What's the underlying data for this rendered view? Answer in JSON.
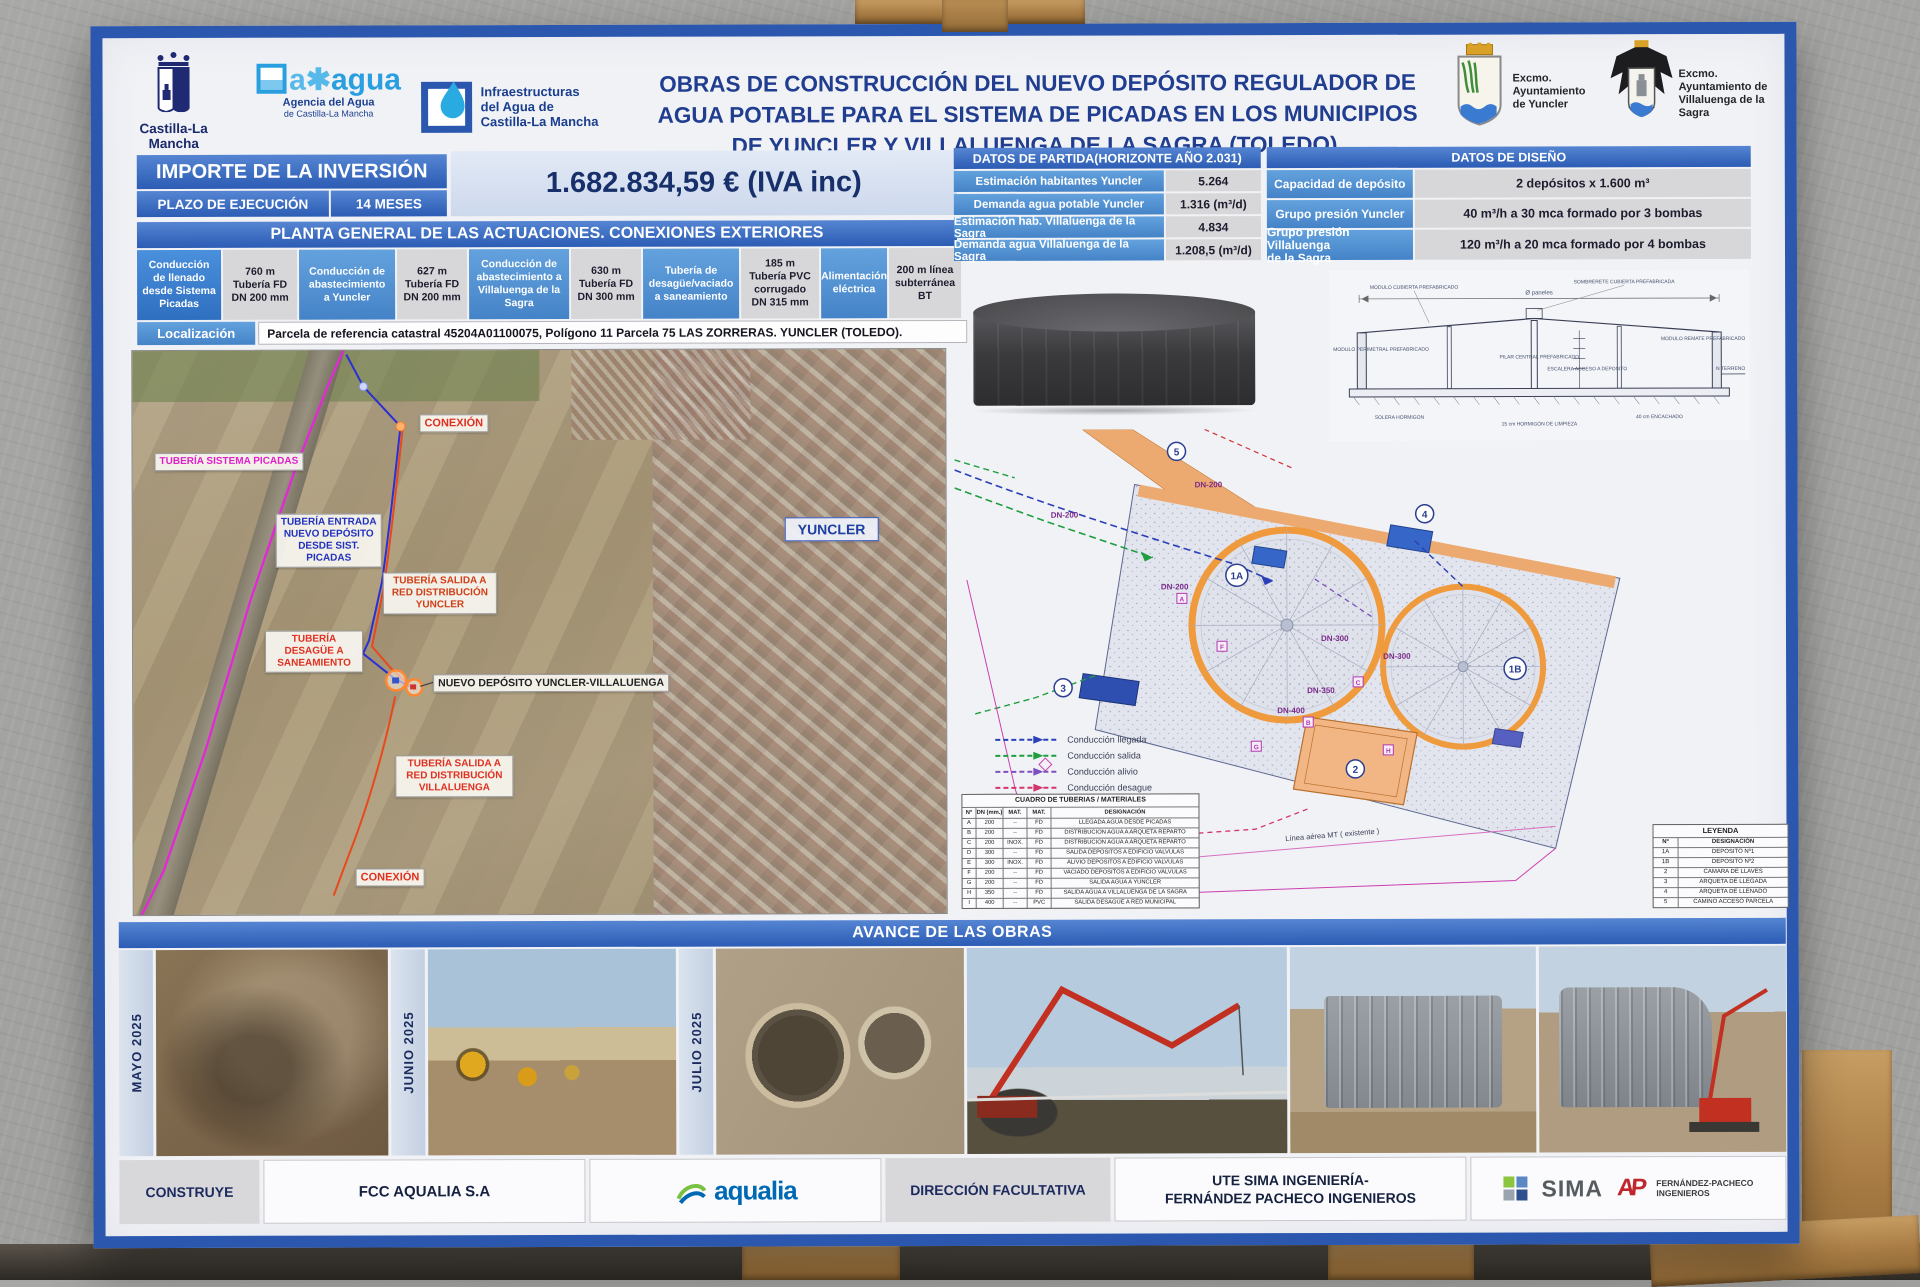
{
  "header": {
    "title": "OBRAS DE CONSTRUCCIÓN DEL NUEVO DEPÓSITO REGULADOR DE\nAGUA POTABLE PARA EL SISTEMA DE PICADAS EN LOS MUNICIPIOS\nDE YUNCLER Y VILLALUENGA DE LA SAGRA (TOLEDO).",
    "logo_clm": {
      "name": "Castilla-La Mancha"
    },
    "logo_agua": {
      "prefix": "a✱",
      "brand": "agua",
      "line1": "Agencia del Agua",
      "line2": "de Castilla-La Mancha"
    },
    "logo_infra": {
      "text": "Infraestructuras\ndel Agua de\nCastilla-La Mancha"
    },
    "arms_yuncler": {
      "text": "Excmo.\nAyuntamiento\nde Yuncler"
    },
    "arms_villaluenga": {
      "text": "Excmo.\nAyuntamiento de\nVillaluenga de la\nSagra"
    }
  },
  "investment": {
    "label": "IMPORTE DE LA INVERSIÓN",
    "term_label": "PLAZO DE EJECUCIÓN",
    "term_value": "14 MESES",
    "amount": "1.682.834,59 € (IVA inc)"
  },
  "planta": {
    "title": "PLANTA GENERAL DE LAS ACTUACIONES. CONEXIONES EXTERIORES",
    "cells": [
      "Conducción\nde llenado\ndesde Sistema\nPicadas",
      "760 m\nTubería FD\nDN 200 mm",
      "Conducción de\nabastecimiento\na Yuncler",
      "627 m\nTubería FD\nDN 200 mm",
      "Conducción de\nabastecimiento a\nVillaluenga de la\nSagra",
      "630 m\nTubería FD\nDN 300 mm",
      "Tubería de\ndesagüe/vaciado\na saneamiento",
      "185 m\nTubería PVC\ncorrugado\nDN 315 mm",
      "Alimentación\neléctrica",
      "200 m línea\nsubterránea\nBT"
    ],
    "localizacion_label": "Localización",
    "localizacion_value": "Parcela de referencia catastral 45204A01100075, Polígono 11 Parcela 75 LAS ZORRERAS. YUNCLER (TOLEDO)."
  },
  "datos_partida": {
    "title": "DATOS DE PARTIDA(HORIZONTE AÑO 2.031)",
    "rows": [
      [
        "Estimación habitantes Yuncler",
        "5.264"
      ],
      [
        "Demanda agua potable Yuncler",
        "1.316 (m³/d)"
      ],
      [
        "Estimación hab. Villaluenga de la Sagra",
        "4.834"
      ],
      [
        "Demanda agua Villaluenga de la Sagra",
        "1.208,5 (m³/d)"
      ]
    ]
  },
  "datos_diseno": {
    "title": "DATOS DE DISEÑO",
    "rows": [
      [
        "Capacidad de depósito",
        "2 depósitos x 1.600 m³"
      ],
      [
        "Grupo presión Yuncler",
        "40 m³/h a 30 mca formado por 3 bombas"
      ],
      [
        "Grupo presión Villaluenga\nde la Sagra",
        "120 m³/h a 20 mca formado por 4 bombas"
      ]
    ]
  },
  "map": {
    "labels": {
      "sistema": "TUBERÍA SISTEMA PICADAS",
      "conexion_top": "CONEXIÓN",
      "entrada": "TUBERÍA ENTRADA\nNUEVO DEPÓSITO\nDESDE SIST.\nPICADAS",
      "salida_yuncler": "TUBERÍA SALIDA A\nRED DISTRIBUCIÓN\nYUNCLER",
      "desague": "TUBERÍA\nDESAGÜE A\nSANEAMIENTO",
      "nuevo_deposito": "NUEVO DEPÓSITO YUNCLER-VILLALUENGA",
      "salida_villaluenga": "TUBERÍA SALIDA A\nRED DISTRIBUCIÓN\nVILLALUENGA",
      "conexion_bottom": "CONEXIÓN",
      "town": "YUNCLER"
    }
  },
  "plan": {
    "legend": [
      {
        "label": "Conducción llegada",
        "color": "#2a3fb8"
      },
      {
        "label": "Conducción salida",
        "color": "#1e9e3e"
      },
      {
        "label": "Conducción alivio",
        "color": "#7d4fc0"
      },
      {
        "label": "Conducción desague",
        "color": "#d4356a"
      }
    ],
    "linea_aerea": "Línea aérea MT ( existente )",
    "dn_labels": [
      "DN-200",
      "DN-200",
      "DN-200",
      "DN-300",
      "DN-300",
      "DN-350",
      "DN-400"
    ],
    "callouts": {
      "c1a": "1A",
      "c1b": "1B",
      "c2": "2",
      "c3": "3",
      "c4": "4",
      "c5": "5"
    },
    "section_labels": [
      "SOMBRERETE CUBIERTA PREFABRICADA",
      "MODULO CUBIERTA PREFABRICADO",
      "MODULO PERIMETRAL PREFABRICADO",
      "PILAR CENTRAL PREFABRICADO",
      "ESCALERA ACCESO A DEPOSITO",
      "MODULO REMATE PREFABRICADO",
      "N TERRENO",
      "SOLERA HORMIGON",
      "15 cm HORMIGÓN DE LIMPIEZA",
      "40 cm ENCACHADO",
      "Ø paneles"
    ],
    "cuadro": {
      "title": "CUADRO DE TUBERIAS / MATERIALES",
      "headers": [
        "Nº",
        "DN (mm.)",
        "MAT.",
        "MAT.",
        "DESIGNACIÓN"
      ],
      "rows": [
        [
          "A",
          "200",
          "--",
          "FD",
          "LLEGADA AGUA DESDE PICADAS"
        ],
        [
          "B",
          "200",
          "--",
          "FD",
          "DISTRIBUCION AGUA A ARQUETA REPARTO"
        ],
        [
          "C",
          "200",
          "INOX.",
          "FD",
          "DISTRIBUCION AGUA A ARQUETA REPARTO"
        ],
        [
          "D",
          "300",
          "--",
          "FD",
          "SALIDA DEPOSITOS A EDIFICIO VALVULAS"
        ],
        [
          "E",
          "300",
          "INOX.",
          "FD",
          "ALIVIO DEPOSITOS A EDIFICIO VALVULAS"
        ],
        [
          "F",
          "200",
          "--",
          "FD",
          "VACIADO DEPOSITOS A EDIFICIO VALVULAS"
        ],
        [
          "G",
          "200",
          "--",
          "FD",
          "SALIDA AGUA A YUNCLER"
        ],
        [
          "H",
          "350",
          "--",
          "FD",
          "SALIDA AGUA A VILLALUENGA DE LA SAGRA"
        ],
        [
          "I",
          "400",
          "--",
          "PVC",
          "SALIDA DESAGUE A RED MUNICIPAL"
        ]
      ]
    },
    "leyenda": {
      "title": "LEYENDA",
      "headers": [
        "Nº",
        "DESIGNACIÓN"
      ],
      "rows": [
        [
          "1A",
          "DEPOSITO Nº1"
        ],
        [
          "1B",
          "DEPOSITO Nº2"
        ],
        [
          "2",
          "CAMARA DE LLAVES"
        ],
        [
          "3",
          "ARQUETA DE LLEGADA"
        ],
        [
          "4",
          "ARQUETA DE LLENADO"
        ],
        [
          "5",
          "CAMINO ACCESO PARCELA"
        ]
      ]
    }
  },
  "avance": {
    "title": "AVANCE DE LAS OBRAS",
    "months": [
      "MAYO 2025",
      "JUNIO 2025",
      "JULIO 2025"
    ]
  },
  "footer": {
    "construye": "CONSTRUYE",
    "empresa": "FCC AQUALIA S.A",
    "aqualia": "aqualia",
    "direccion": "DIRECCIÓN FACULTATIVA",
    "ute": "UTE SIMA INGENIERÍA-\nFERNÁNDEZ PACHECO INGENIEROS",
    "sima": "SIMA",
    "fp_monogram": "AP",
    "fp": "FERNÁNDEZ-PACHECO\nINGENIEROS"
  }
}
